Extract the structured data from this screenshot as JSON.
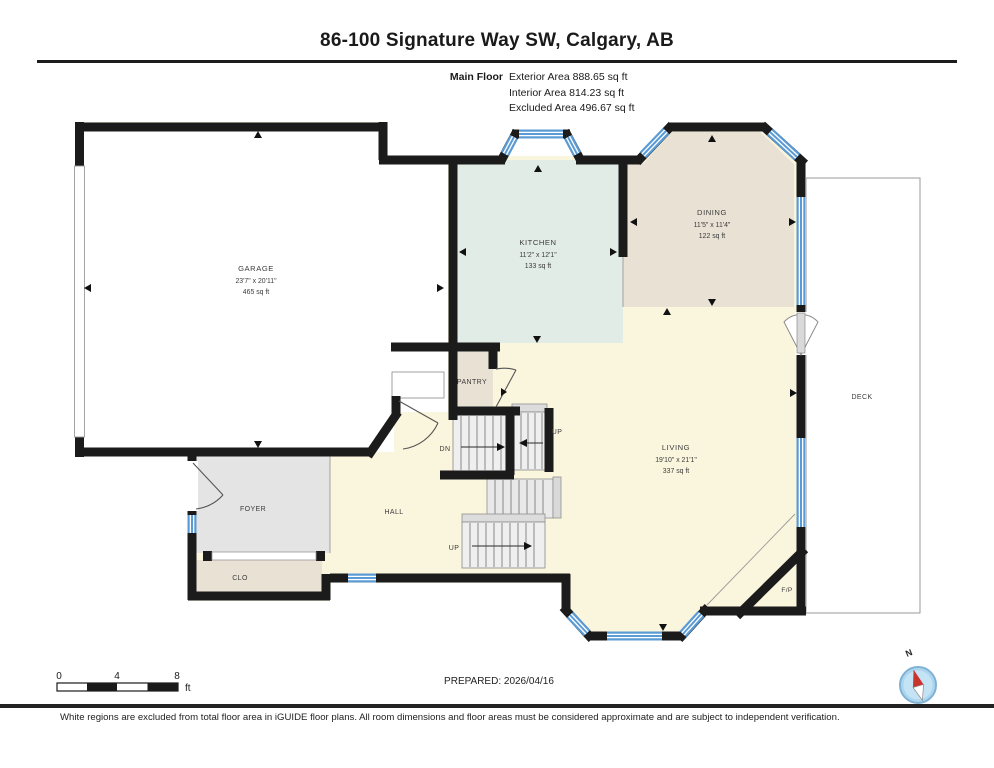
{
  "header": {
    "title": "86-100 Signature Way SW, Calgary, AB",
    "floor_label": "Main Floor",
    "exterior_area": "Exterior Area 888.65 sq ft",
    "interior_area": "Interior Area 814.23 sq ft",
    "excluded_area": "Excluded Area 496.67 sq ft"
  },
  "rooms": {
    "garage": {
      "name": "GARAGE",
      "dims": "23'7\" x 20'11\"",
      "area": "465 sq ft"
    },
    "kitchen": {
      "name": "KITCHEN",
      "dims": "11'2\" x 12'1\"",
      "area": "133 sq ft"
    },
    "dining": {
      "name": "DINING",
      "dims": "11'5\" x 11'4\"",
      "area": "122 sq ft"
    },
    "living": {
      "name": "LIVING",
      "dims": "19'10\" x 21'1\"",
      "area": "337 sq ft"
    },
    "pantry": {
      "name": "PANTRY"
    },
    "foyer": {
      "name": "FOYER"
    },
    "hall": {
      "name": "HALL"
    },
    "closet": {
      "name": "CLO"
    },
    "deck": {
      "name": "DECK"
    },
    "fireplace": {
      "name": "F/P"
    }
  },
  "stairs": {
    "down_label": "DN",
    "up_label_1": "UP",
    "up_label_2": "UP"
  },
  "scale_bar": {
    "tick_0": "0",
    "tick_4": "4",
    "tick_8": "8",
    "unit": "ft"
  },
  "prepared": "PREPARED: 2026/04/16",
  "compass": {
    "north_label": "N"
  },
  "disclaimer": "White regions are excluded from total floor area in iGUIDE floor plans. All room dimensions and floor areas must be considered approximate and are subject to independent verification.",
  "colors": {
    "wall": "#1b1b1b",
    "window_blue": "#5b9bd5",
    "kitchen_fill": "#e2ece7",
    "dining_fill": "#e9e1d4",
    "living_fill": "#faf5dd",
    "foyer_fill": "#e4e4e4",
    "closet_fill": "#e9e1d4",
    "stair_fill": "#efefef",
    "deck_border": "#999999",
    "compass_blue": "#add6ee",
    "compass_red": "#c9342c"
  }
}
